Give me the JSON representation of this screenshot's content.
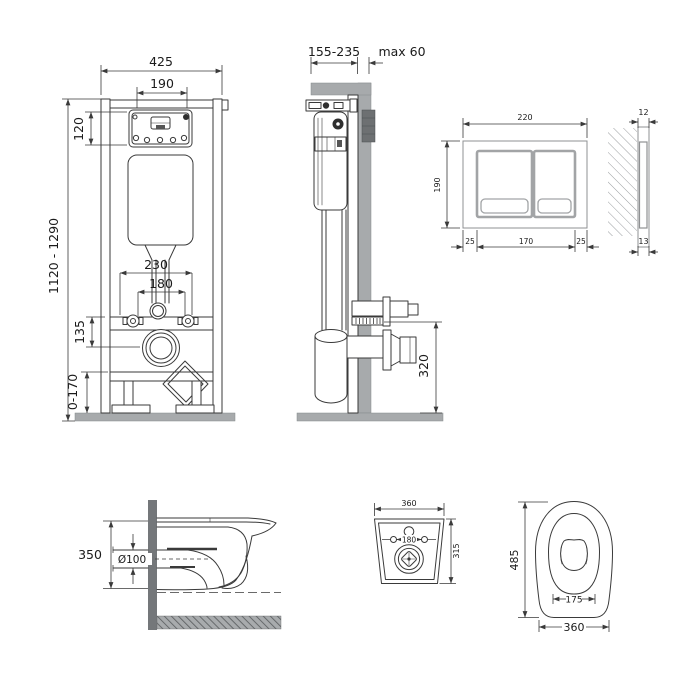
{
  "drawing": {
    "frame_front": {
      "dims": {
        "overall_width": "425",
        "inner_width": "190",
        "box_height": "120",
        "height_range": "1120 - 1290",
        "spacing_wide": "230",
        "spacing_narrow": "180",
        "outlet_drop": "135",
        "feet_range": "0-170"
      }
    },
    "frame_side": {
      "dims": {
        "depth_range": "155-235",
        "wall_max": "max 60",
        "outlet_height": "320"
      }
    },
    "plate_front": {
      "dims": {
        "width": "220",
        "height": "190",
        "margin_left": "25",
        "buttons_span": "170",
        "margin_right": "25"
      }
    },
    "plate_side": {
      "dims": {
        "thickness_top": "12",
        "thickness_bottom": "13"
      }
    },
    "bowl_side": {
      "dims": {
        "height": "350",
        "outlet_diameter": "Ø100"
      }
    },
    "mount_top": {
      "dims": {
        "width": "360",
        "depth": "315",
        "bolt_spacing": "180"
      }
    },
    "bowl_top": {
      "dims": {
        "length": "485",
        "hinge_spacing": "175",
        "width": "360"
      }
    }
  },
  "colors": {
    "line": "#3a3a3a",
    "wall_fill": "#a7aaac",
    "dark_fill": "#6d7072",
    "background": "#ffffff"
  }
}
